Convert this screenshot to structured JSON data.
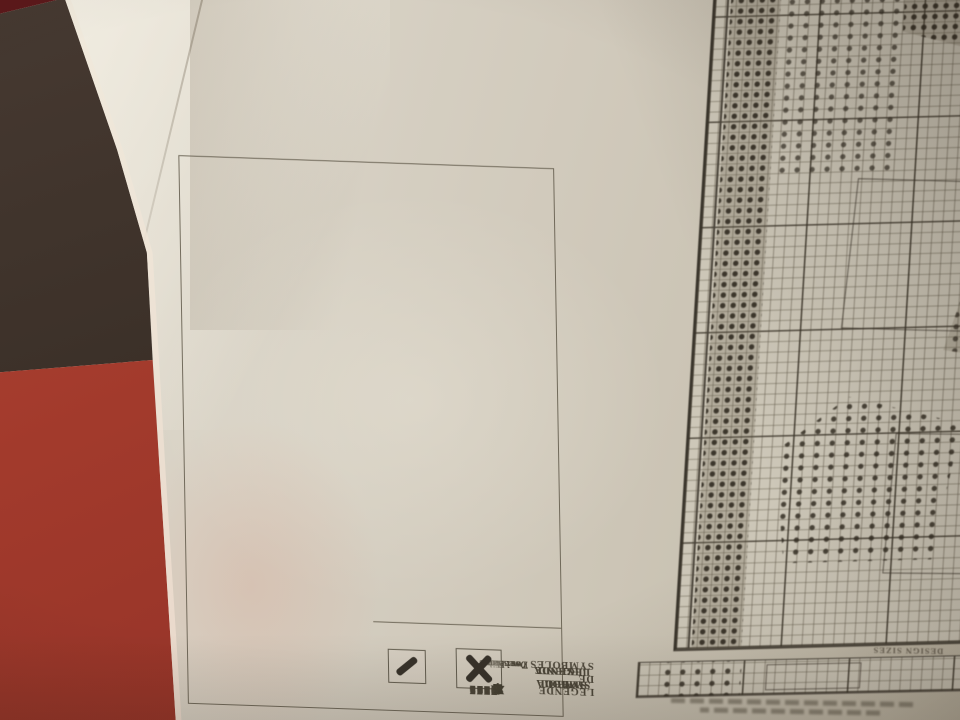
{
  "scene": {
    "colors": {
      "background_dark": "#3a2f27",
      "sofa_red": "#a23a2c",
      "sofa_red_dark": "#5c181a",
      "paper": "#d8d2c5",
      "ink": "#4b4538",
      "box_line": "#5f594a",
      "grid_bg": "#cdc7b8",
      "stitch_dark": "#37322a"
    }
  },
  "legend": {
    "title_lines": [
      "SYMBOL LEGEND",
      "LEGENDE DE SYMBOLES",
      "SIMBOLA LEYENDA",
      "SYMBOL LEGENDE"
    ],
    "strands": {
      "lines": [
        "Two strands",
        "Deux brins",
        "Dos hebras",
        "Zwei Fäden"
      ],
      "full_stitch_symbol": "full-cross-stitch",
      "half_stitch_symbol": "half-stitch"
    },
    "columns": [
      {
        "rows": [
          {
            "symbol": "·",
            "code": "000"
          },
          {
            "symbol": "▶",
            "code": "301"
          },
          {
            "symbol": "■",
            "code": "310"
          },
          {
            "symbol": "▨",
            "code": "319"
          },
          {
            "symbol": "✙",
            "code": "321"
          },
          {
            "symbol": "☂",
            "code": "322"
          },
          {
            "symbol": "=",
            "code": "453"
          },
          {
            "symbol": "♯",
            "code": "470"
          },
          {
            "symbol": "5",
            "code": "472"
          },
          {
            "symbol": "◔",
            "code": "535"
          },
          {
            "symbol": "–",
            "code": "605"
          },
          {
            "symbol": "#",
            "code": "647"
          },
          {
            "symbol": "+",
            "code": "722"
          },
          {
            "symbol": ">",
            "code": "744"
          },
          {
            "symbol": "(",
            "code": "743"
          },
          {
            "symbol": "/",
            "code": "772"
          },
          {
            "symbol": "●",
            "code": "797"
          }
        ]
      },
      {
        "rows": [
          {
            "symbol": "^",
            "code": "800"
          },
          {
            "symbol": "ϕ",
            "code": "813"
          },
          {
            "symbol": "▼",
            "code": "815"
          },
          {
            "symbol": "✖",
            "code": "920"
          },
          {
            "symbol": "a",
            "code": "922"
          },
          {
            "symbol": "2",
            "code": "956"
          },
          {
            "symbol": "%",
            "code": "959"
          },
          {
            "symbol": "↑",
            "code": "986"
          },
          {
            "symbol": "§",
            "code": "988"
          },
          {
            "symbol": "✚",
            "code": "991"
          },
          {
            "symbol": "Ж",
            "code": "3607"
          },
          {
            "symbol": "~",
            "code": "3609"
          },
          {
            "symbol": "7",
            "code": "3776"
          },
          {
            "symbol": ")",
            "code": "3801"
          },
          {
            "symbol": "✤",
            "code": "3812"
          },
          {
            "symbol": "✻",
            "code": "3823"
          },
          {
            "symbol": "◕",
            "code": "3834"
          }
        ]
      }
    ]
  },
  "chart": {
    "caption": "DESIGN SIZES"
  }
}
